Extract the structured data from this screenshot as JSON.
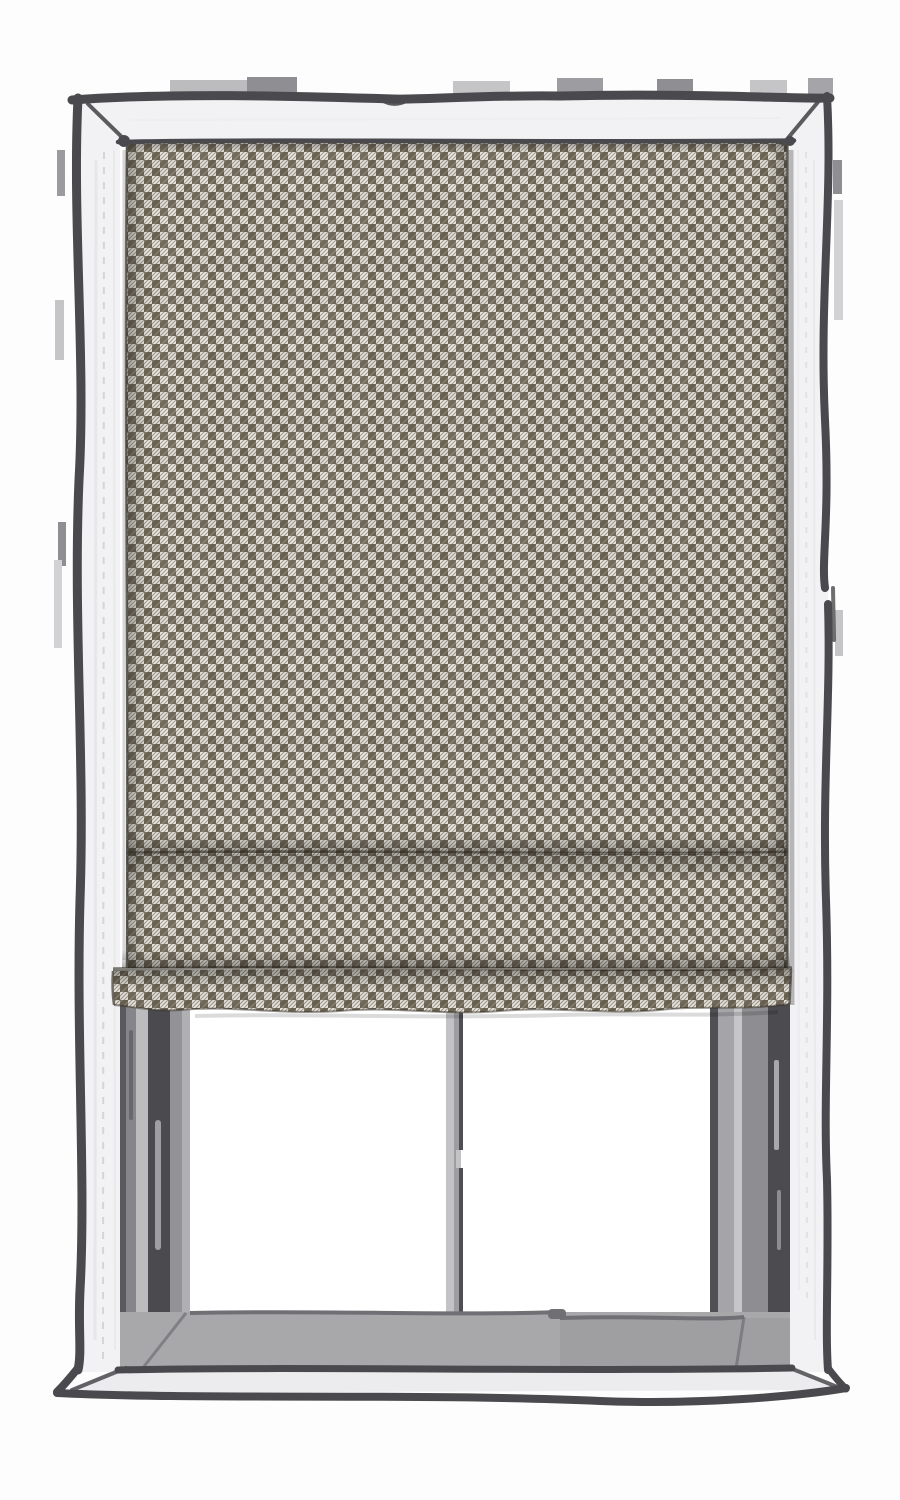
{
  "scene": {
    "description": "Hand-drawn sketch illustration of a window with a brown houndstooth roman blind lowered about three quarters of the way, two white window panes visible below the blind",
    "style": "ink outline sketch with flat fills",
    "objects": [
      "window frame",
      "roman blind",
      "window panes",
      "center mullion",
      "window sill"
    ]
  },
  "blind": {
    "pattern_name": "houndstooth-check",
    "visible_fold_creases": 2,
    "coverage": "about 75% of window height",
    "hem": "bottom hem slab protrudes slightly to the left with a ragged lower edge"
  },
  "window": {
    "pane_count": 2,
    "mullion_count": 1,
    "sill": "gray inner sill with lighter outer ledge below"
  },
  "colors": {
    "page_bg": "#fdfdfd",
    "outline_dark": "#4a4a4e",
    "frame_white": "#f2f2f4",
    "frame_streak": "#e3e3e6",
    "stitch_line": "#d2d2d6",
    "ledge_light": "#ececee",
    "sill_gray": "#a8a8ab",
    "sill_edge": "#6f6f74",
    "jamb_base": "#98989b",
    "jamb_dark": "#4a4a4f",
    "jamb_mid": "#8a8a8e",
    "jamb_light": "#bcbcbf",
    "mullion_light": "#c3c3c6",
    "mullion_mid": "#9e9ea2",
    "mullion_edge": "#4f4f53",
    "pane_white": "#ffffff",
    "fabric_brown": "#6b6353",
    "fabric_cream": "#e9e6de",
    "wall_mark_dark": "#8f8f93",
    "wall_mark_light": "#c5c5c8"
  }
}
